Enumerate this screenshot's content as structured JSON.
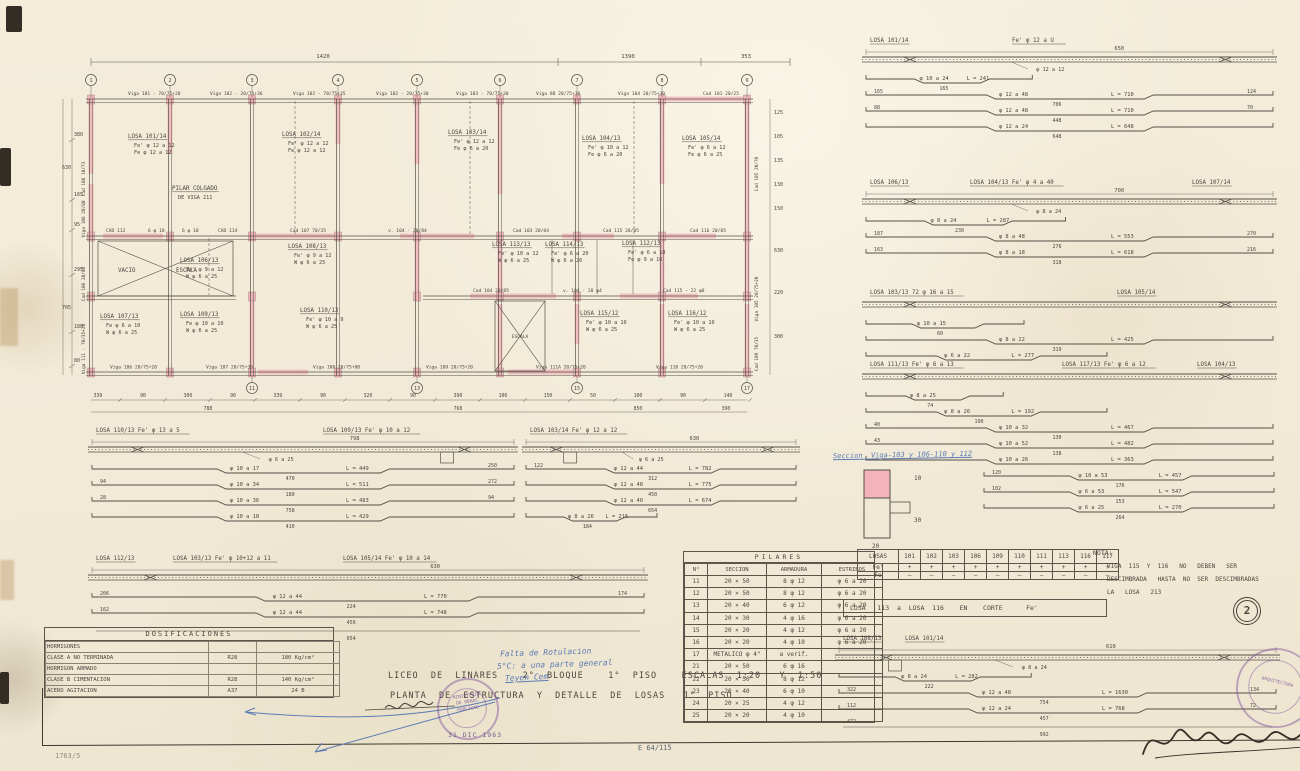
{
  "page": {
    "number": "2",
    "date_stamp": "31 DIC 1963"
  },
  "title_block": {
    "line1": "LICEO  DE  LINARES    2°  BLOQUE    1°  PISO    ESCALAS  1:20   Y  1:50",
    "line2": "PLANTA  DE  ESTRUCTURA  Y  DETALLE  DE  LOSAS   1°  PISO"
  },
  "dosificaciones": {
    "title": "DOSIFICACIONES",
    "rows": [
      [
        "HORMIGONES",
        "",
        ""
      ],
      [
        "CLASE  A    NO TERMINADA",
        "R28",
        "180 Kg/cm²"
      ],
      [
        "HORMIGON    ARMADO",
        "",
        ""
      ],
      [
        "CLASE  B    CIMENTACION",
        "R28",
        "140 Kg/cm²"
      ],
      [
        "ACERO       AGITACION",
        "A37",
        "24 B"
      ]
    ]
  },
  "pilares": {
    "title": "PILARES",
    "headers": [
      "N°",
      "SECCION",
      "ARMADURA",
      "ESTRIBOS"
    ],
    "rows": [
      [
        "11",
        "20 × 50",
        "8 φ 12",
        "φ 6 a 20"
      ],
      [
        "12",
        "20 × 50",
        "8 φ 12",
        "φ 6 a 20"
      ],
      [
        "13",
        "20 × 40",
        "6 φ 12",
        "φ 6 a 20"
      ],
      [
        "14",
        "20 × 30",
        "4 φ 16",
        "φ 6 a 20"
      ],
      [
        "15",
        "20 × 20",
        "4 φ 12",
        "φ 6 a 20"
      ],
      [
        "16",
        "20 × 20",
        "4 φ 10",
        "φ 6 a 20"
      ],
      [
        "17",
        "METALICO φ 4\"",
        "a verif.",
        ""
      ],
      [
        "21",
        "20 × 50",
        "6 φ 16",
        ""
      ],
      [
        "22",
        "20 × 50",
        "8 φ 12",
        ""
      ],
      [
        "23",
        "20 × 40",
        "6 φ 10",
        ""
      ],
      [
        "24",
        "20 × 25",
        "4 φ 12",
        ""
      ],
      [
        "25",
        "20 × 20",
        "4 φ 10",
        ""
      ]
    ]
  },
  "losas_table": {
    "title": "LOSAS",
    "columns": [
      "101",
      "102",
      "103",
      "106",
      "109",
      "110",
      "111",
      "113",
      "116",
      "117"
    ],
    "row_fe_prime": {
      "label": "Fe'",
      "symbol": "+"
    },
    "row_fe": {
      "label": "Fe",
      "symbol": "—"
    }
  },
  "corte_note": "LOSA   113  a  LOSA  116    EN    CORTE      Fe'",
  "nota": {
    "title": "NOTA:",
    "lines": [
      "VIGA  115  Y  116   NO   DEBEN   SER",
      "DESCIMBRADA   HASTA  NO  SER  DESCIMBRADAS",
      "LA   LOSA   213"
    ]
  },
  "annotations": {
    "seccion_note": "Seccion  Viga-103 y 106-110 y 112",
    "t_dims": [
      "10",
      "30",
      "20"
    ],
    "blue_note": [
      "Falta de Rotulacion",
      "5°C: a una parte general",
      "Teyen Cem"
    ],
    "ref_code": "E 64/115",
    "pencil_note": "1763/5"
  },
  "stamps": {
    "ministry": [
      "MINISTERIO",
      "DE OBRAS",
      "PUBLICAS",
      "ARQUITECTURA"
    ]
  },
  "plan": {
    "dims_top": [
      "1420",
      "1390",
      "353"
    ],
    "grid_top": [
      "1",
      "2",
      "3",
      "4",
      "5",
      "6",
      "7",
      "8",
      "9"
    ],
    "grid_bottom": [
      "11",
      "13",
      "15",
      "17"
    ],
    "beams_top": [
      "Viga 101 - 70/75+20",
      "Viga 102 - 20/75+36",
      "Viga 102 - 70/75+35",
      "Viga 102 - 20/75+30",
      "Viga 103 - 70/75+30",
      "Viga 80  20/75+30",
      "Viga 104  20/75+30",
      "Cad 101  20/25"
    ],
    "beams_mid": [
      "CAD 112",
      "6 φ 18",
      "6 φ 18",
      "CAD 114",
      "Cad 107  70/35",
      "v. 104 - 20/84",
      "Cad 103  20/84",
      "Cad 115  20/85",
      "Cad 116  20/85"
    ],
    "beams_mid2": [
      "Cad 104  20/85",
      "v. 104 - 20 φ4",
      "Cad 115 - 22 φ8"
    ],
    "beams_bottom": [
      "Viga 106  20/75+20",
      "Viga 107  20/75+35",
      "Viga 108  20/75+80",
      "Viga 109  20/75+20",
      "Viga 111A  20/75+20",
      "Viga 110  20/75+20"
    ],
    "left_labels": [
      "Cad 108  10/73",
      "Viga 106  20/80",
      "Cad 106  20/80",
      "Viga 111 - 70/35+20"
    ],
    "right_labels": [
      "Cad 105  20/70",
      "Viga 105  20/75+20",
      "Cad 109  70/35"
    ],
    "dims_left_inner": [
      "380",
      "165",
      "95",
      "295",
      "180",
      "80"
    ],
    "dims_left_outer": [
      "630",
      "705"
    ],
    "dims_right": [
      "125",
      "105",
      "135",
      "130",
      "150",
      "630",
      "220",
      "300"
    ],
    "dims_bottom1": [
      "339",
      "90",
      "300",
      "90",
      "339",
      "90",
      "320",
      "90",
      "390",
      "100",
      "150",
      "50",
      "100",
      "90",
      "140"
    ],
    "dims_bottom2": [
      "788",
      "768",
      "850",
      "390"
    ],
    "vacio_label": "VACIO",
    "escala_label": "ESCALA",
    "escala2_label": "ESCALA",
    "rooms": [
      {
        "n": "LOSA 101/14",
        "a": "Fe' φ 12 a 12",
        "b": "Fe  φ 12 a 12",
        "x": 70,
        "y": 94
      },
      {
        "n": "LOSA 102/14",
        "a": "Fe' φ 12 a 12",
        "b": "Fe  φ 12 a 12",
        "x": 224,
        "y": 92
      },
      {
        "n": "LOSA 103/14",
        "a": "Fe' φ 12 a 12",
        "b": "Fe  φ 6 a 20",
        "x": 390,
        "y": 90
      },
      {
        "n": "LOSA 104/13",
        "a": "Fe' φ 10 a 12",
        "b": "Fe  φ 6 a 20",
        "x": 524,
        "y": 96
      },
      {
        "n": "LOSA 105/14",
        "a": "Fe' φ 6 a 12",
        "b": "Fe  φ 6 a 25",
        "x": 624,
        "y": 96
      },
      {
        "n": "PILAR COLGADO",
        "a": "DE  VIGA  211",
        "b": "",
        "x": 114,
        "y": 146
      },
      {
        "n": "LOSA 106/13",
        "a": "Fe' φ 9 a 12",
        "b": "W  φ 6 a 25",
        "x": 122,
        "y": 218
      },
      {
        "n": "LOSA 108/13",
        "a": "Fe' φ 9 a 12",
        "b": "W  φ 6 a 25",
        "x": 230,
        "y": 204
      },
      {
        "n": "LOSA 113/13",
        "a": "Fe' φ 10 a 12",
        "b": "W  φ 6 a 25",
        "x": 434,
        "y": 202
      },
      {
        "n": "LOSA 114/13",
        "a": "Fe' φ 6 a 20",
        "b": "W  φ 6 a 20",
        "x": 487,
        "y": 202
      },
      {
        "n": "LOSA 112/13",
        "a": "Fe' φ 6 a 18",
        "b": "Fe  φ 9 a 16",
        "x": 564,
        "y": 201
      },
      {
        "n": "LOSA 107/13",
        "a": "Fe  φ 6 a 10",
        "b": "W  φ 6 a 25",
        "x": 42,
        "y": 274
      },
      {
        "n": "LOSA 109/13",
        "a": "Fe  φ 10 a 10",
        "b": "W  φ 6 a 25",
        "x": 122,
        "y": 272
      },
      {
        "n": "LOSA 110/13",
        "a": "Fe' φ 10 a 9",
        "b": "W  φ 6 a 25",
        "x": 242,
        "y": 268
      },
      {
        "n": "LOSA 115/12",
        "a": "Fe' φ 10 a 10",
        "b": "W  φ 6 a 25",
        "x": 522,
        "y": 271
      },
      {
        "n": "LOSA 116/12",
        "a": "Fe' φ 10 a 10",
        "b": "W  φ 6 a 25",
        "x": 610,
        "y": 271
      }
    ]
  },
  "details": [
    {
      "x": 862,
      "y": 34,
      "w": 415,
      "titles": [
        [
          "LOSA 101/14",
          8
        ],
        [
          "Fe'   φ  12 a U",
          150
        ]
      ],
      "dim": "650",
      "slab": true,
      "slabNote": "φ 12 a 12",
      "stubs": [],
      "bars": [
        {
          "l": "",
          "phi": "φ 10 a 24",
          "L": "L = 241",
          "u": "165",
          "r": "",
          "wf": 0.42
        },
        {
          "l": "165",
          "phi": "φ 12 a 48",
          "L": "L = 710",
          "u": "706",
          "r": "124"
        },
        {
          "l": "88",
          "phi": "φ 12 a 48",
          "L": "L = 710",
          "u": "448",
          "r": "70"
        },
        {
          "l": "",
          "phi": "φ 12 a 24",
          "L": "L = 648",
          "u": "648",
          "r": ""
        }
      ]
    },
    {
      "x": 862,
      "y": 176,
      "w": 415,
      "titles": [
        [
          "LOSA 106/13",
          8
        ],
        [
          "LOSA 104/13   Fe' φ 4 a 40",
          108
        ],
        [
          "LOSA 107/14",
          330
        ]
      ],
      "dim": "700",
      "slab": true,
      "slabNote": "φ 8 a 24",
      "stubs": [],
      "bars": [
        {
          "l": "",
          "phi": "φ 8 a 24",
          "L": "L = 287",
          "u": "230",
          "r": "",
          "wf": 0.5
        },
        {
          "l": "187",
          "phi": "φ 8 a 48",
          "L": "L = 553",
          "u": "276",
          "r": "270"
        },
        {
          "l": "163",
          "phi": "φ 8 a 18",
          "L": "L = 618",
          "u": "318",
          "r": "216"
        }
      ]
    },
    {
      "x": 862,
      "y": 286,
      "w": 415,
      "titles": [
        [
          "LOSA 103/13   72 φ 16 a 15",
          8
        ],
        [
          "LOSA 105/14",
          255
        ]
      ],
      "dim": "",
      "slab": true,
      "slabNote": "",
      "stubs": [],
      "bars": [
        {
          "l": "",
          "phi": "φ 10 a 15",
          "L": "",
          "u": "60",
          "r": "",
          "wf": 0.4
        },
        {
          "l": "",
          "phi": "φ 8 a 22",
          "L": "L = 425",
          "u": "319",
          "r": ""
        },
        {
          "l": "",
          "phi": "φ 6 a 22",
          "L": "L = 277",
          "u": "",
          "r": "",
          "wf": 0.6
        }
      ]
    },
    {
      "x": 862,
      "y": 358,
      "w": 415,
      "titles": [
        [
          "LOSA 111/13   Fe' φ 6 a 13",
          8
        ],
        [
          "LOSA 117/13   Fe' φ 6 a 12",
          200
        ],
        [
          "LOSA 104/13",
          335
        ]
      ],
      "dim": "",
      "slab": true,
      "slabNote": "",
      "stubs": [],
      "bars": [
        {
          "l": "",
          "phi": "φ 8 a 25",
          "L": "",
          "u": "74",
          "r": "",
          "wf": 0.35
        },
        {
          "l": "",
          "phi": "φ 8 a 26",
          "L": "L = 192",
          "u": "190",
          "r": "",
          "wf": 0.6
        }
      ]
    },
    {
      "x": 862,
      "y": 414,
      "w": 415,
      "titles": [],
      "dim": "",
      "slab": false,
      "slabNote": "",
      "stubs": [],
      "bars": [
        {
          "l": "40",
          "phi": "φ 10 a 32",
          "L": "L = 467",
          "u": "130",
          "r": ""
        },
        {
          "l": "43",
          "phi": "φ 10 a 52",
          "L": "L = 482",
          "u": "138",
          "r": ""
        },
        {
          "l": "",
          "phi": "φ 10 a 26",
          "L": "L = 363",
          "u": "",
          "r": ""
        }
      ]
    },
    {
      "x": 980,
      "y": 462,
      "w": 298,
      "titles": [],
      "dim": "",
      "slab": false,
      "slabNote": "",
      "stubs": [],
      "bars": [
        {
          "l": "120",
          "phi": "φ 10 a 53",
          "L": "L = 457",
          "u": "176",
          "r": ""
        },
        {
          "l": "102",
          "phi": "φ 6 a 53",
          "L": "L = 547",
          "u": "153",
          "r": ""
        },
        {
          "l": "",
          "phi": "φ 6 a 25",
          "L": "L = 270",
          "u": "264",
          "r": ""
        }
      ]
    },
    {
      "x": 88,
      "y": 424,
      "w": 430,
      "titles": [
        [
          "LOSA 110/13   Fe' φ 13 a 5",
          8
        ],
        [
          "LOSA 109/13   Fe' φ 10 a 12",
          235
        ]
      ],
      "dim": "798",
      "slab": true,
      "slabNote": "φ 6 a 25",
      "stubs": [
        0.82
      ],
      "bars": [
        {
          "l": "",
          "phi": "φ 10 a 17",
          "L": "L = 449",
          "u": "470",
          "r": "250"
        },
        {
          "l": "94",
          "phi": "φ 10 a 34",
          "L": "L = 511",
          "u": "180",
          "r": "272"
        },
        {
          "l": "28",
          "phi": "φ 10 a 36",
          "L": "L = 483",
          "u": "758",
          "r": "94"
        },
        {
          "l": "",
          "phi": "φ 10 a 18",
          "L": "L = 429",
          "u": "410",
          "r": ""
        }
      ]
    },
    {
      "x": 522,
      "y": 424,
      "w": 278,
      "titles": [
        [
          "LOSA 103/14   Fe' φ 12 a 12",
          8
        ]
      ],
      "dim": "630",
      "slab": true,
      "slabNote": "φ 6 a 25",
      "stubs": [
        0.15
      ],
      "bars": [
        {
          "l": "122",
          "phi": "φ 12 a 44",
          "L": "L = 782",
          "u": "312",
          "r": ""
        },
        {
          "l": "",
          "phi": "φ 12 a 48",
          "L": "L = 775",
          "u": "450",
          "r": ""
        },
        {
          "l": "",
          "phi": "φ 12 a 40",
          "L": "L = 674",
          "u": "654",
          "r": ""
        },
        {
          "l": "",
          "phi": "φ 8 a 26",
          "L": "L = 216",
          "u": "184",
          "r": "",
          "wf": 0.5
        }
      ]
    },
    {
      "x": 88,
      "y": 552,
      "w": 560,
      "titles": [
        [
          "LOSA 112/13",
          8
        ],
        [
          "LOSA 103/13  Fe' φ 10+12 a 11",
          85
        ],
        [
          "LOSA 105/14  Fe' φ 10 a 14",
          255
        ]
      ],
      "dim": "630",
      "slab": true,
      "slabNote": "",
      "stubs": [],
      "bars": [
        {
          "l": "206",
          "phi": "φ 12 a 44",
          "L": "L = 770",
          "u": "224",
          "r": "174"
        },
        {
          "l": "162",
          "phi": "φ 12 a 44",
          "L": "L = 748",
          "u": "456",
          "r": ""
        },
        {
          "l": "",
          "phi": "",
          "L": "",
          "u": "654",
          "r": ""
        }
      ]
    },
    {
      "x": 835,
      "y": 632,
      "w": 445,
      "titles": [
        [
          "LOSA 108/13",
          8
        ],
        [
          "LOSA 101/14",
          70
        ]
      ],
      "dim": "610",
      "slab": true,
      "slabNote": "φ 8 a 24",
      "stubs": [
        0.12
      ],
      "bars": [
        {
          "l": "",
          "phi": "φ 8 a 24",
          "L": "L = 282",
          "u": "222",
          "r": "",
          "wf": 0.45
        },
        {
          "l": "322",
          "phi": "φ 12 a 48",
          "L": "L = 1630",
          "u": "754",
          "r": "134"
        },
        {
          "l": "112",
          "phi": "φ 12 a 24",
          "L": "L = 768",
          "u": "457",
          "r": "72"
        },
        {
          "l": "472",
          "phi": "",
          "L": "",
          "u": "992",
          "r": ""
        }
      ]
    }
  ]
}
